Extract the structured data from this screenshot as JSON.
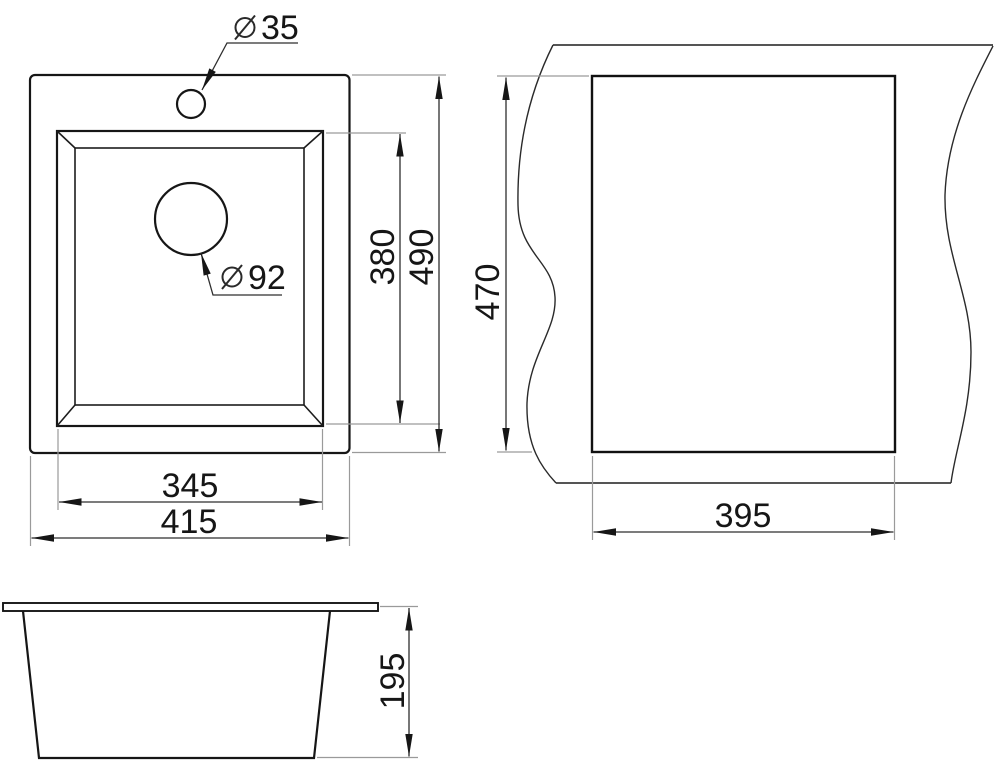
{
  "drawing": {
    "subject": "sink dimension drawing",
    "colors": {
      "background": "#ffffff",
      "outline": "#161616",
      "dimension_line": "#2e2e2e",
      "extension_line": "#9a9a9a"
    },
    "top_view": {
      "faucet_hole_diameter": "35",
      "drain_hole_diameter": "92",
      "bowl_width": "345",
      "overall_width": "415",
      "bowl_depth": "380",
      "overall_depth": "490"
    },
    "cutout_view": {
      "cutout_width": "395",
      "cutout_depth": "470"
    },
    "side_view": {
      "overall_height": "195"
    }
  }
}
